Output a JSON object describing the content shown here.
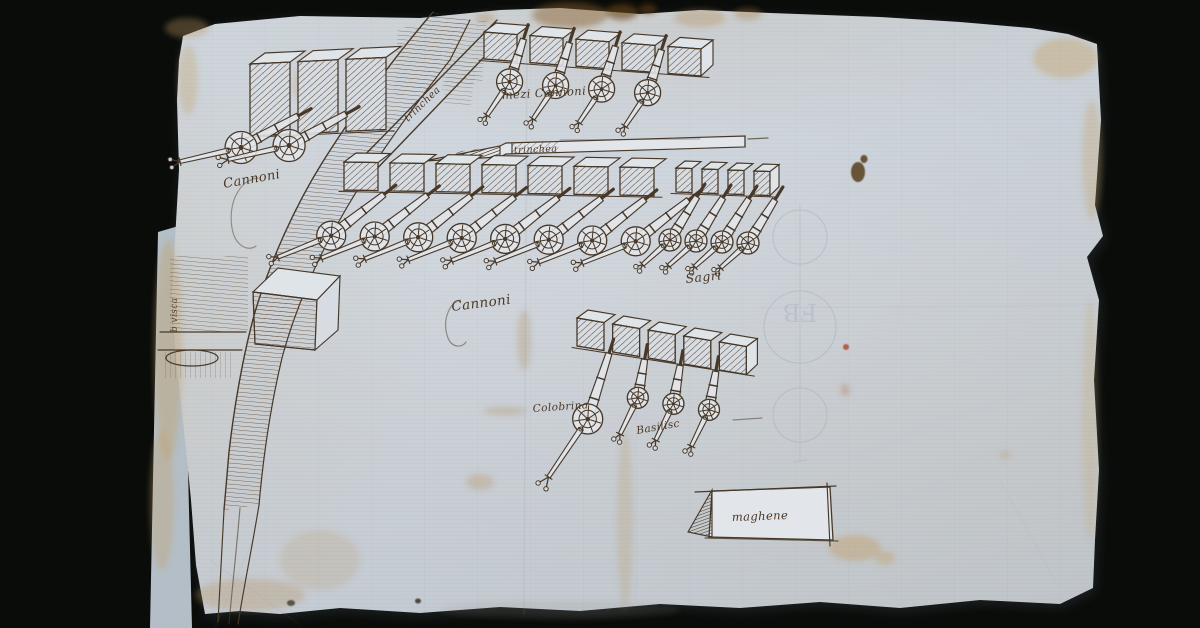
{
  "artwork": {
    "kind": "ink manuscript drawing of artillery batteries on fortification walls",
    "paper_color": "#c9d1d8",
    "ink_color": "#473828",
    "background_color": "#0a0c0a"
  },
  "labels": {
    "left_battery": "Cannoni",
    "top_battery": "mezi Cannoni",
    "main_battery": "Cannoni",
    "sagri": "Sagri",
    "colobrina": "Colobrina",
    "basilisc": "Basilisc",
    "magazine": "maghene",
    "trench_diagonal": "trinchea",
    "trench_log": "trinchea",
    "left_edge_note": "b visca",
    "watermark_initials": "FB"
  },
  "batteries": [
    {
      "key": "left_battery",
      "label": "Cannoni",
      "guns": 2
    },
    {
      "key": "top_battery",
      "label": "mezi Cannoni",
      "guns": 4
    },
    {
      "key": "main_battery",
      "label": "Cannoni",
      "guns": 8
    },
    {
      "key": "sagri",
      "label": "Sagri",
      "guns": 4
    },
    {
      "key": "bottom_battery",
      "label": "Colobrina / Basilisc",
      "guns": 4
    }
  ]
}
